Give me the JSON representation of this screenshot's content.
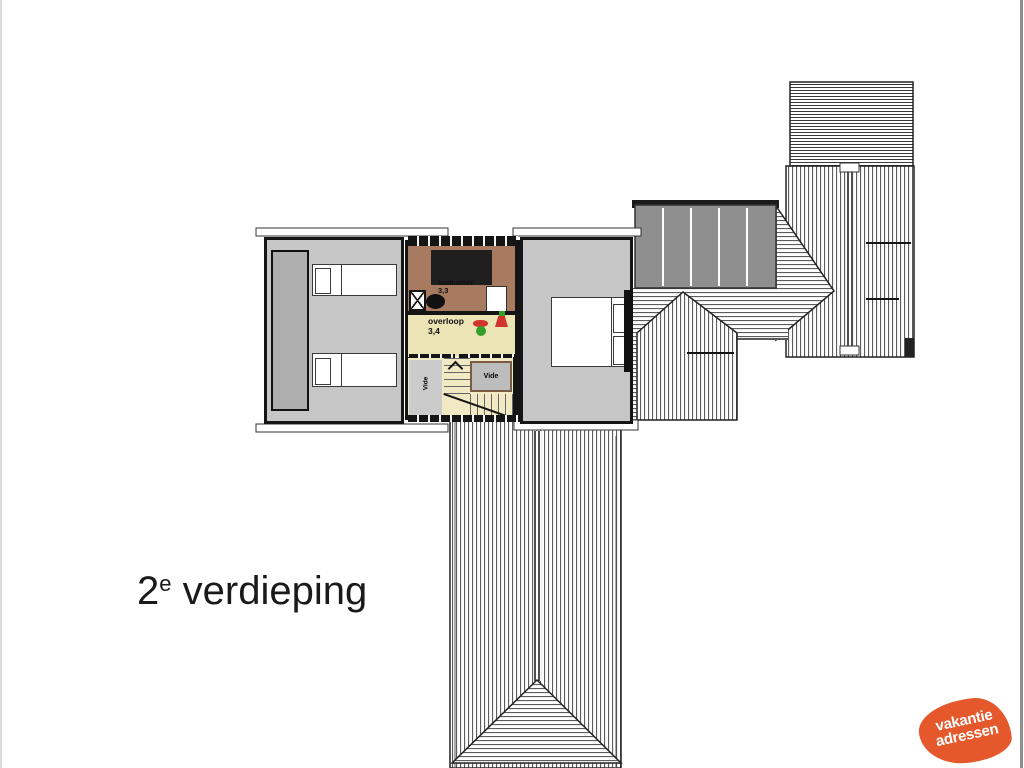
{
  "page": {
    "background": "#ffffff",
    "edge_left_color": "#dcdcdc",
    "edge_right_color": "#8f8f8f"
  },
  "title": {
    "number": "2",
    "superscript": "e",
    "word": "verdieping",
    "color": "#1a1a1a"
  },
  "floor_plan": {
    "rooms": {
      "badkamer": {
        "label": "badkamer",
        "area": "3,3",
        "unit": "m²",
        "floor_color": "#A87B61"
      },
      "overloop": {
        "label": "overloop",
        "area": "3,4",
        "floor_color": "#EDE4B6"
      },
      "stairwell": {
        "vide_left_label": "Vide",
        "vide_box_label": "Vide",
        "floor_color": "#F0E9C4"
      },
      "bedroom_left": {
        "floor_color": "#C6C6C6"
      },
      "bedroom_right": {
        "floor_color": "#C6C6C6"
      }
    },
    "colors": {
      "wall": "#151515",
      "roof_hatch_line": "#4a4a4a",
      "roof_panels_gray": "#8F8F8F",
      "wardrobe_gray": "#AEAEAE",
      "vide_box_gray": "#BDBDBD",
      "safety_icon_red": "#D0342C",
      "safety_icon_green": "#33A02C"
    }
  },
  "logo": {
    "line1": "vakantie",
    "line2": "adressen",
    "background": "#E4582B",
    "text_color": "#ffffff"
  }
}
